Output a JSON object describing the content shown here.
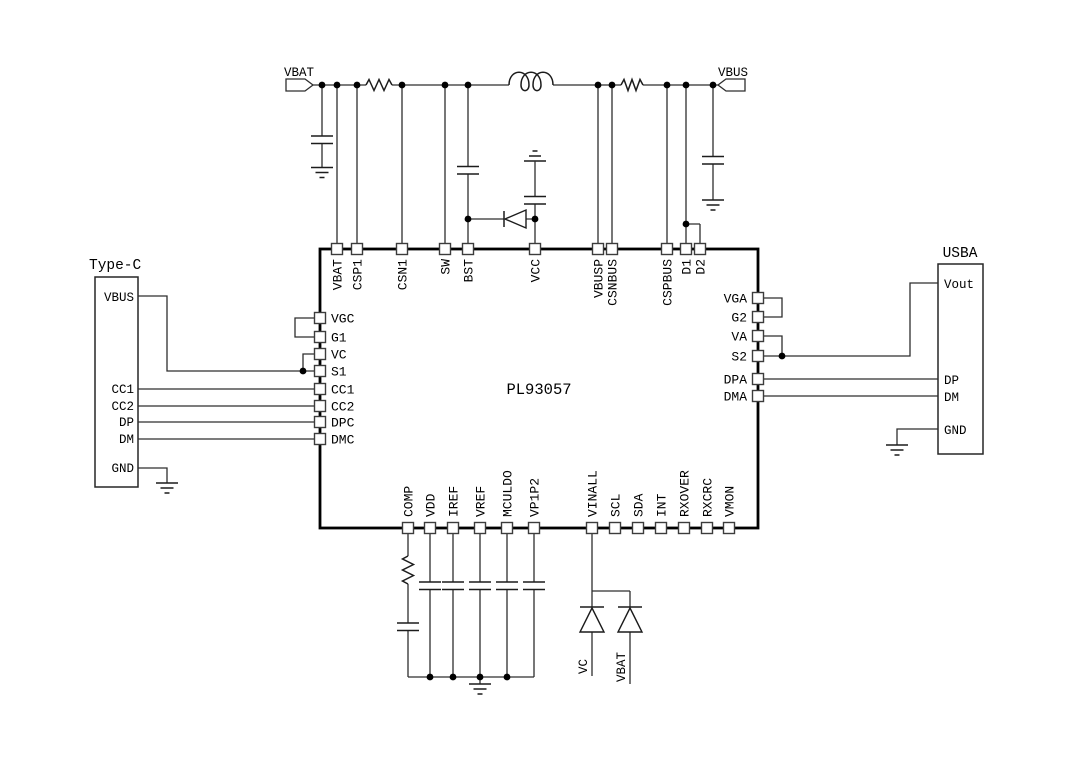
{
  "chip": {
    "name": "PL93057",
    "top_pins": [
      "VBAT",
      "CSP1",
      "CSN1",
      "SW",
      "BST",
      "VCC",
      "VBUSP",
      "CSNBUS",
      "CSPBUS",
      "D1",
      "D2"
    ],
    "left_pins": [
      "VGC",
      "G1",
      "VC",
      "S1",
      "CC1",
      "CC2",
      "DPC",
      "DMC"
    ],
    "right_pins": [
      "VGA",
      "G2",
      "VA",
      "S2",
      "DPA",
      "DMA"
    ],
    "bottom_pins": [
      "COMP",
      "VDD",
      "IREF",
      "VREF",
      "MCULDO",
      "VP1P2",
      "VINALL",
      "SCL",
      "SDA",
      "INT",
      "RXOVER",
      "RXCRC",
      "VMON"
    ]
  },
  "typec": {
    "title": "Type-C",
    "pins": [
      "VBUS",
      "CC1",
      "CC2",
      "DP",
      "DM",
      "GND"
    ]
  },
  "usba": {
    "title": "USBA",
    "pins": [
      "Vout",
      "DP",
      "DM",
      "GND"
    ]
  },
  "terminals": {
    "left": "VBAT",
    "right": "VBUS"
  },
  "net_labels": {
    "left": "VC",
    "right": "VBAT"
  },
  "colors": {
    "line": "#2e2e2e",
    "chip_border": "#000000",
    "background": "#ffffff"
  }
}
